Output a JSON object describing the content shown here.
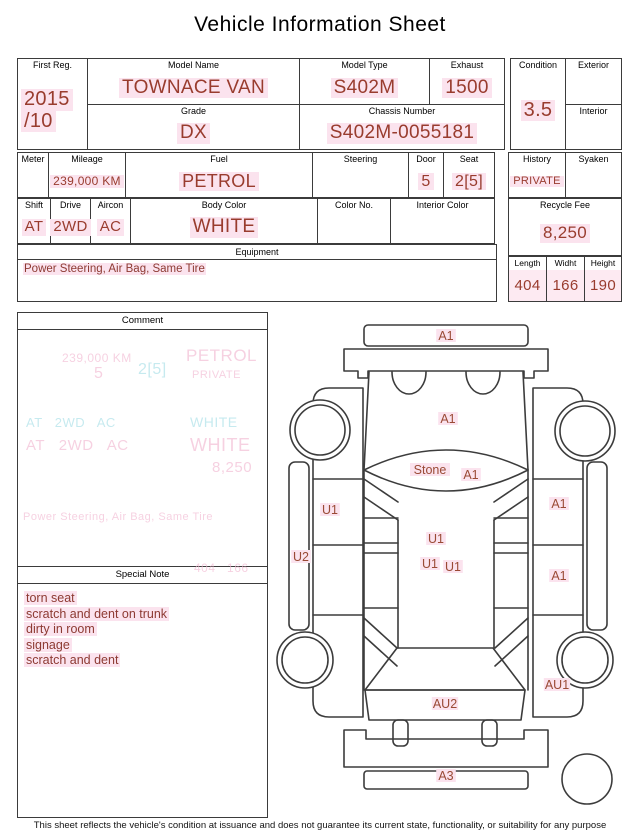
{
  "title": "Vehicle Information Sheet",
  "top": {
    "first_reg": {
      "label": "First Reg.",
      "value_line1": "2015",
      "value_line2": "/10"
    },
    "model_name": {
      "label": "Model Name",
      "value": "TOWNACE VAN"
    },
    "model_type": {
      "label": "Model Type",
      "value": "S402M"
    },
    "exhaust": {
      "label": "Exhaust",
      "value": "1500"
    },
    "grade": {
      "label": "Grade",
      "value": "DX"
    },
    "chassis_number": {
      "label": "Chassis Number",
      "value": "S402M-0055181"
    },
    "condition": {
      "label": "Condition",
      "value": "3.5"
    },
    "exterior": {
      "label": "Exterior",
      "value": ""
    },
    "interior": {
      "label": "Interior",
      "value": ""
    }
  },
  "specs": {
    "meter": {
      "label": "Meter",
      "value": ""
    },
    "mileage": {
      "label": "Mileage",
      "value": "239,000 KM"
    },
    "fuel": {
      "label": "Fuel",
      "value": "PETROL"
    },
    "steering": {
      "label": "Steering",
      "value": ""
    },
    "door": {
      "label": "Door",
      "value": "5"
    },
    "seat": {
      "label": "Seat",
      "value": "2[5]"
    },
    "history": {
      "label": "History",
      "value": "PRIVATE"
    },
    "syaken": {
      "label": "Syaken",
      "value": ""
    },
    "shift": {
      "label": "Shift",
      "value": "AT"
    },
    "drive": {
      "label": "Drive",
      "value": "2WD"
    },
    "aircon": {
      "label": "Aircon",
      "value": "AC"
    },
    "body_color": {
      "label": "Body Color",
      "value": "WHITE"
    },
    "color_no": {
      "label": "Color No.",
      "value": ""
    },
    "interior_color": {
      "label": "Interior Color",
      "value": ""
    },
    "recycle_fee": {
      "label": "Recycle Fee",
      "value": "8,250"
    },
    "equipment": {
      "label": "Equipment",
      "value": "Power Steering, Air Bag, Same Tire"
    },
    "dimensions": {
      "length": {
        "label": "Length",
        "value": "404"
      },
      "width": {
        "label": "Widht",
        "value": "166"
      },
      "height": {
        "label": "Height",
        "value": "190"
      }
    }
  },
  "comment": {
    "label": "Comment",
    "ghost_lines": [
      {
        "text": "239,000 KM",
        "x": 44,
        "y": 38,
        "size": 12,
        "color": "pink"
      },
      {
        "text": "PETROL",
        "x": 168,
        "y": 33,
        "size": 17,
        "color": "pink"
      },
      {
        "text": "5",
        "x": 76,
        "y": 52,
        "size": 16,
        "color": "pink"
      },
      {
        "text": "2[5]",
        "x": 120,
        "y": 48,
        "size": 16,
        "color": "cyan"
      },
      {
        "text": "PRIVATE",
        "x": 174,
        "y": 56,
        "size": 11,
        "color": "pink"
      },
      {
        "text": "AT   2WD   AC",
        "x": 8,
        "y": 102,
        "size": 13,
        "color": "cyan"
      },
      {
        "text": "AT   2WD   AC",
        "x": 8,
        "y": 124,
        "size": 15,
        "color": "pink"
      },
      {
        "text": "WHITE",
        "x": 172,
        "y": 101,
        "size": 14,
        "color": "cyan"
      },
      {
        "text": "WHITE",
        "x": 172,
        "y": 122,
        "size": 18,
        "color": "pink"
      },
      {
        "text": "8,250",
        "x": 194,
        "y": 146,
        "size": 15,
        "color": "pink"
      },
      {
        "text": "Power Steering, Air Bag, Same Tire",
        "x": 5,
        "y": 198,
        "size": 11,
        "color": "pink"
      },
      {
        "text": "404   166",
        "x": 176,
        "y": 248,
        "size": 12,
        "color": "pink"
      }
    ]
  },
  "special_note": {
    "label": "Special Note",
    "items": [
      "torn seat",
      "scratch and dent on trunk",
      "dirty in room",
      "signage",
      "scratch and dent"
    ]
  },
  "diagram": {
    "labels": [
      {
        "text": "A1",
        "x": 174,
        "y": 28
      },
      {
        "text": "A1",
        "x": 176,
        "y": 111
      },
      {
        "text": "Stone",
        "x": 158,
        "y": 162
      },
      {
        "text": "A1",
        "x": 199,
        "y": 167
      },
      {
        "text": "U1",
        "x": 58,
        "y": 202
      },
      {
        "text": "A1",
        "x": 287,
        "y": 196
      },
      {
        "text": "U2",
        "x": 29,
        "y": 249
      },
      {
        "text": "U1",
        "x": 164,
        "y": 231
      },
      {
        "text": "U1",
        "x": 158,
        "y": 256
      },
      {
        "text": "U1",
        "x": 181,
        "y": 259
      },
      {
        "text": "A1",
        "x": 287,
        "y": 268
      },
      {
        "text": "AU1",
        "x": 285,
        "y": 377
      },
      {
        "text": "AU2",
        "x": 173,
        "y": 396
      },
      {
        "text": "A3",
        "x": 174,
        "y": 468
      }
    ]
  },
  "footer": {
    "disclaimer": "This sheet reflects the vehicle's condition at issuance and does not guarantee its current state, functionality, or suitability for any purpose"
  },
  "colors": {
    "value_text": "#993c2e",
    "note_text": "#8d3a32",
    "diagram_label": "#9a4a35",
    "highlight": "#fbe3ee",
    "ghost_pink": "#f2b9d2",
    "ghost_cyan": "#a9dfe7",
    "border": "#3b3b3b"
  }
}
